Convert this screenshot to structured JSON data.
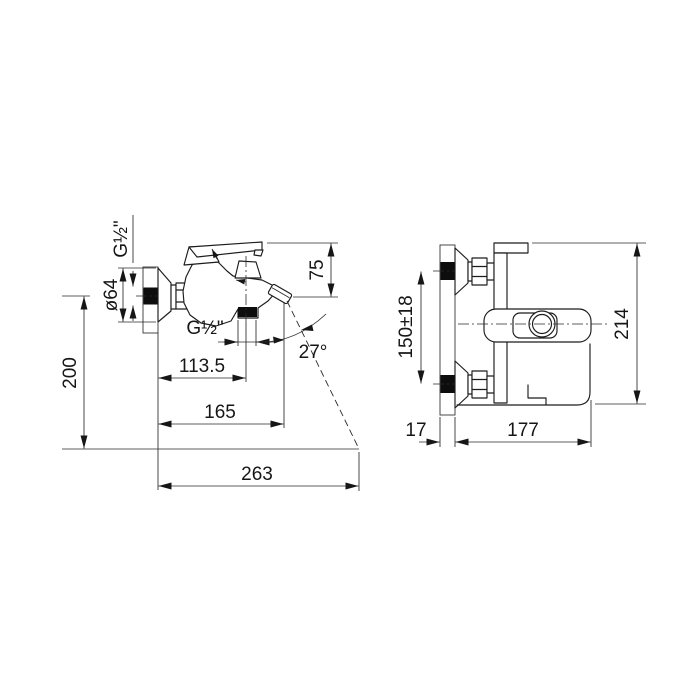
{
  "drawing_type": "bath-mixer-installation-dimensions",
  "labels": {
    "left_view": {
      "thread_top": "G½\"",
      "flange_diameter": "ø64",
      "height_to_rim": "200",
      "spout_thread": "G½\"",
      "outlet_offset": "113.5",
      "spout_reach": "165",
      "stream_reach": "263",
      "handle_height": "75",
      "stream_angle": "27°"
    },
    "right_view": {
      "connection_spacing": "150±18",
      "overall_width": "214",
      "wall_thickness": "17",
      "body_depth": "177"
    }
  },
  "colors": {
    "line": "#1c1c1c",
    "background": "#ffffff"
  }
}
